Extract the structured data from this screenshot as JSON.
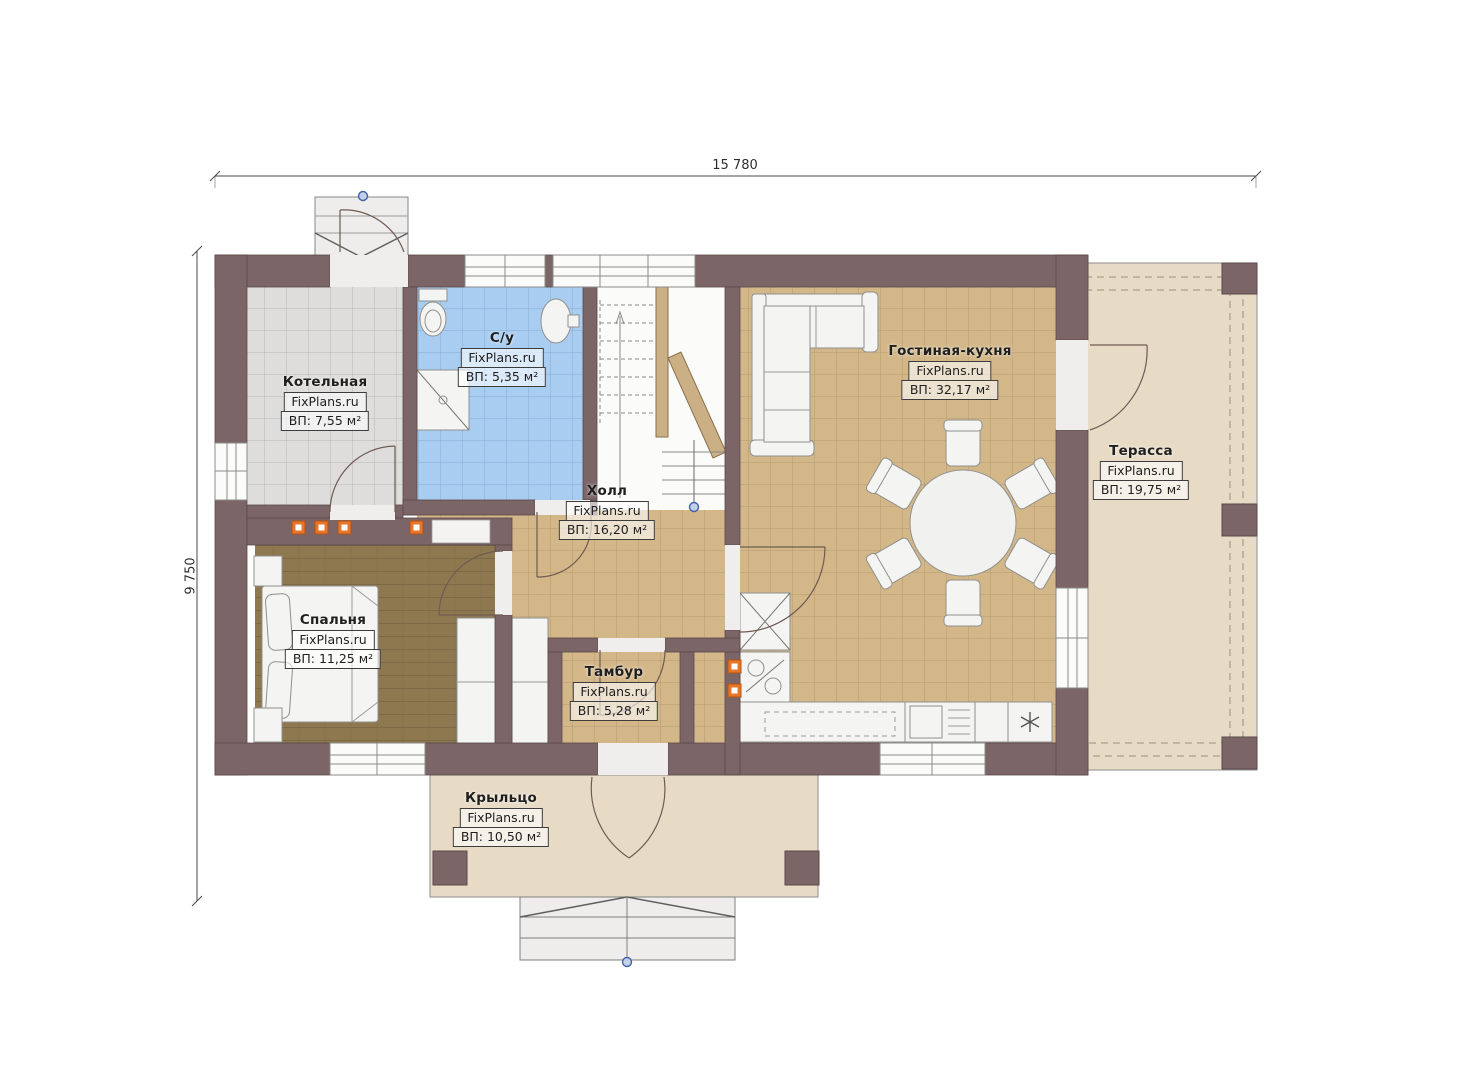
{
  "plan": {
    "type": "floor-plan",
    "dimensions": {
      "width_label": "15 780",
      "height_label": "9 750"
    },
    "watermark": "FixPlans.ru"
  },
  "rooms": [
    {
      "id": "kotelnaya",
      "name": "Котельная",
      "brand": "FixPlans.ru",
      "area": "ВП: 7,55 м²"
    },
    {
      "id": "su",
      "name": "С/у",
      "brand": "FixPlans.ru",
      "area": "ВП: 5,35 м²"
    },
    {
      "id": "gostinaya",
      "name": "Гостиная-кухня",
      "brand": "FixPlans.ru",
      "area": "ВП: 32,17 м²"
    },
    {
      "id": "terassa",
      "name": "Терасса",
      "brand": "FixPlans.ru",
      "area": "ВП: 19,75 м²"
    },
    {
      "id": "holl",
      "name": "Холл",
      "brand": "FixPlans.ru",
      "area": "ВП: 16,20 м²"
    },
    {
      "id": "spalnya",
      "name": "Спальня",
      "brand": "FixPlans.ru",
      "area": "ВП: 11,25 м²"
    },
    {
      "id": "tambur",
      "name": "Тамбур",
      "brand": "FixPlans.ru",
      "area": "ВП: 5,28 м²"
    },
    {
      "id": "krylco",
      "name": "Крыльцо",
      "brand": "FixPlans.ru",
      "area": "ВП: 10,50 м²"
    }
  ],
  "colors": {
    "wall": "#7c6567",
    "wall_edge": "#5a484a",
    "tile_tan": "#d3b789",
    "tile_gray": "#dedddb",
    "tile_blue": "#a9cdf1",
    "wood_floor": "#8d7850",
    "slab": "#e7dbc6",
    "furniture": "#f4f4f2",
    "vent_orange": "#e8762a",
    "marker_blue": "#3f62a8"
  }
}
